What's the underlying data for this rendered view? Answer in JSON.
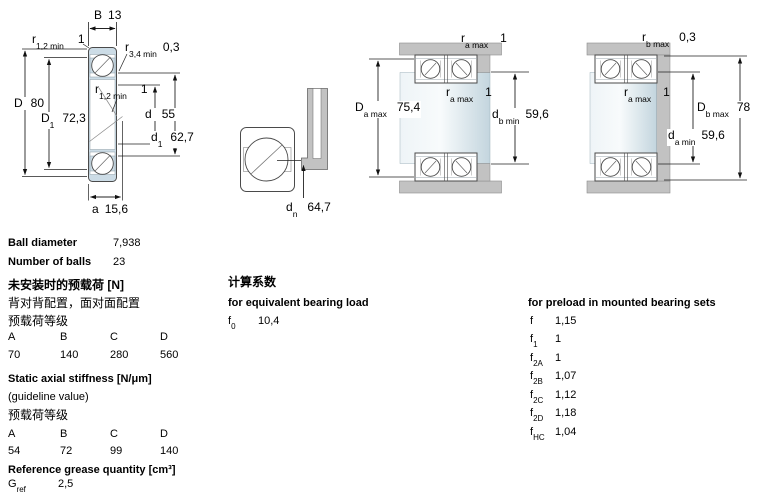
{
  "colors": {
    "ring_fill": "#ccdce6",
    "housing_gray": "#c2c2c2",
    "line": "#4a4a4a"
  },
  "drawing": {
    "dims": {
      "B": {
        "sym": "B",
        "sub": "",
        "value": "13"
      },
      "r12_top": {
        "sym": "r",
        "sub": "1,2 min",
        "value": "1"
      },
      "r34": {
        "sym": "r",
        "sub": "3,4 min",
        "value": "0,3"
      },
      "D": {
        "sym": "D",
        "sub": "",
        "value": "80"
      },
      "D1": {
        "sym": "D",
        "sub": "1",
        "value": "72,3"
      },
      "r12_mid": {
        "sym": "r",
        "sub": "1,2 min",
        "value": "1"
      },
      "d": {
        "sym": "d",
        "sub": "",
        "value": "55"
      },
      "d1": {
        "sym": "d",
        "sub": "1",
        "value": "62,7"
      },
      "a": {
        "sym": "a",
        "sub": "",
        "value": "15,6"
      },
      "dn": {
        "sym": "d",
        "sub": "n",
        "value": "64,7"
      },
      "ra_top": {
        "sym": "r",
        "sub": "a max",
        "value": "1"
      },
      "ra_mid": {
        "sym": "r",
        "sub": "a max",
        "value": "1"
      },
      "Da": {
        "sym": "D",
        "sub": "a max",
        "value": "75,4"
      },
      "db": {
        "sym": "d",
        "sub": "b min",
        "value": "59,6"
      },
      "rb_top": {
        "sym": "r",
        "sub": "b max",
        "value": "0,3"
      },
      "ra_mid2": {
        "sym": "r",
        "sub": "a max",
        "value": "1"
      },
      "Db": {
        "sym": "D",
        "sub": "b max",
        "value": "78"
      },
      "da": {
        "sym": "d",
        "sub": "a min",
        "value": "59,6"
      }
    }
  },
  "specs": {
    "ball_diameter_label": "Ball diameter",
    "ball_diameter_value": "7,938",
    "number_of_balls_label": "Number of balls",
    "number_of_balls_value": "23"
  },
  "preload_unmounted": {
    "title": "未安装时的预载荷 [N]",
    "subtitle": "背对背配置，面对面配置",
    "class_label": "预载荷等级",
    "headers": [
      "A",
      "B",
      "C",
      "D"
    ],
    "values": [
      "70",
      "140",
      "280",
      "560"
    ]
  },
  "stiffness": {
    "title": "Static axial stiffness [N/μm]",
    "subtitle": "(guideline value)",
    "class_label": "预载荷等级",
    "headers": [
      "A",
      "B",
      "C",
      "D"
    ],
    "values": [
      "54",
      "72",
      "99",
      "140"
    ]
  },
  "grease": {
    "title": "Reference grease quantity [cm³]",
    "symbol": "G",
    "symbol_sub": "ref",
    "value": "2,5"
  },
  "calc_factors": {
    "title": "计算系数",
    "subtitle": "for equivalent bearing load",
    "symbol": "f",
    "symbol_sub": "0",
    "value": "10,4"
  },
  "preload_factors": {
    "title": "for preload in mounted bearing sets",
    "rows": [
      {
        "sym": "f",
        "sub": "",
        "value": "1,15"
      },
      {
        "sym": "f",
        "sub": "1",
        "value": "1"
      },
      {
        "sym": "f",
        "sub": "2A",
        "value": "1"
      },
      {
        "sym": "f",
        "sub": "2B",
        "value": "1,07"
      },
      {
        "sym": "f",
        "sub": "2C",
        "value": "1,12"
      },
      {
        "sym": "f",
        "sub": "2D",
        "value": "1,18"
      },
      {
        "sym": "f",
        "sub": "HC",
        "value": "1,04"
      }
    ]
  }
}
